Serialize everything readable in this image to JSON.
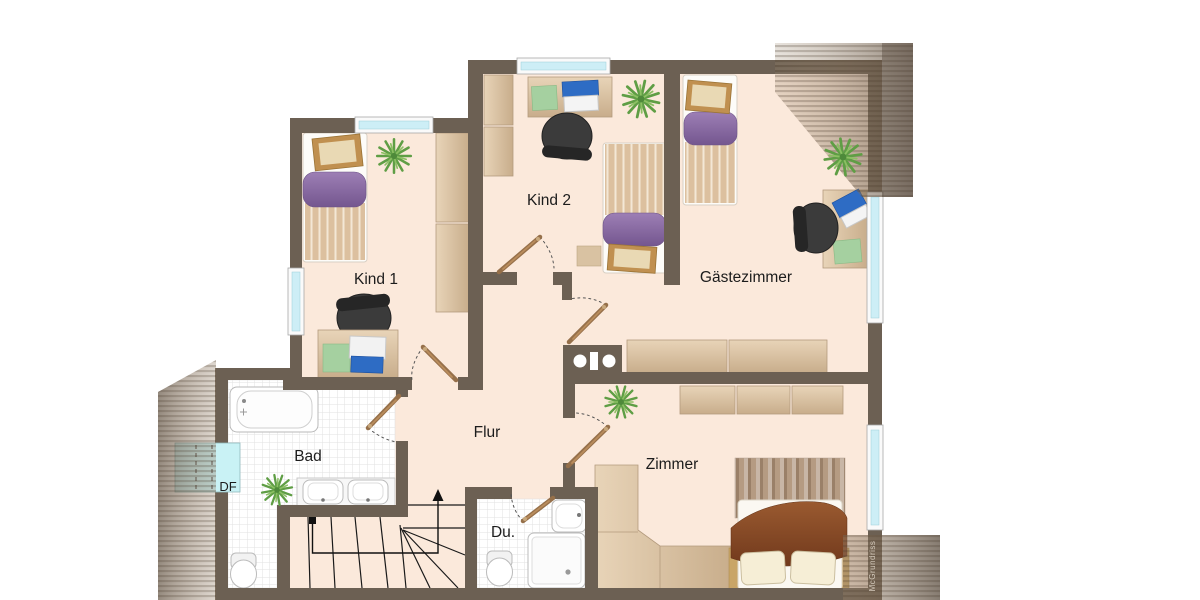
{
  "plan": {
    "type": "floor-plan",
    "floor": "attic storey with roof slopes",
    "rooms": {
      "kind1": {
        "label": "Kind 1"
      },
      "kind2": {
        "label": "Kind 2"
      },
      "gaestezimmer": {
        "label": "Gästezimmer"
      },
      "flur": {
        "label": "Flur"
      },
      "bad": {
        "label": "Bad"
      },
      "df": {
        "label": "DF"
      },
      "du": {
        "label": "Du."
      },
      "zimmer": {
        "label": "Zimmer"
      }
    },
    "watermark": "McGrundriss",
    "colors": {
      "wall": "#6c6053",
      "floor": "#fbe9db",
      "tile": "#ffffff",
      "tile_line": "#e2e2e2",
      "window_glass": "#cdeef6",
      "wood_furniture": "#d9c2a2",
      "bed_purple": "#8a6ba5",
      "plant_green": "#6aa84f",
      "blanket_brown": "#8a4a26",
      "laptop_blue": "#2e6cc4",
      "roof_slope": "#8b7560"
    }
  }
}
